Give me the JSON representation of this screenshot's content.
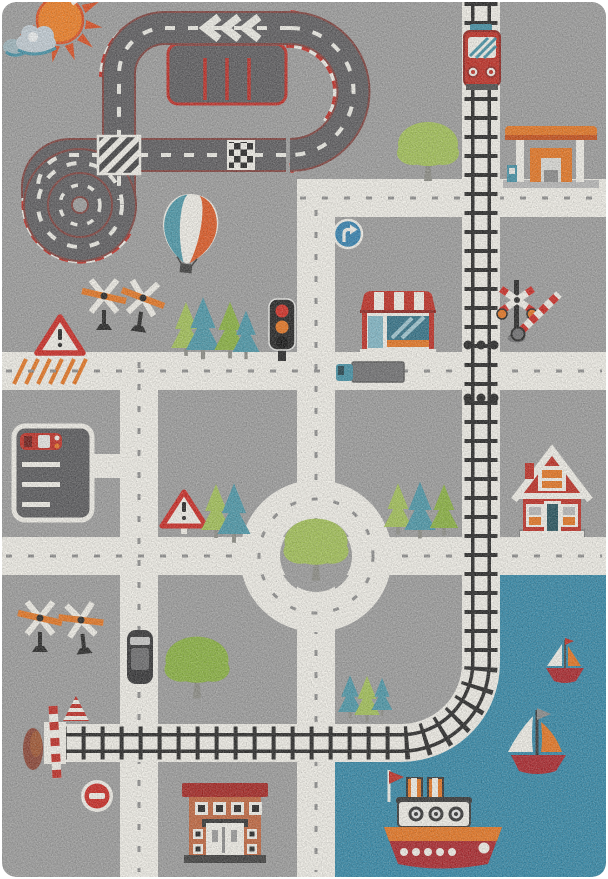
{
  "photo": {
    "subject": "children's city-road play rug, top view product photo",
    "backdrop": "white",
    "style": "knitted / heathered pile texture"
  },
  "palette": {
    "bg": "#9c9c9c",
    "roadWhite": "#f3f1ea",
    "roadTick": "#8d8d8d",
    "asphalt": "#5a595c",
    "asphaltEdge": "#7e3c38",
    "trackDash": "#f0efe8",
    "curbRed": "#c1271f",
    "tie": "#222222",
    "water": "#2f86a7",
    "sun": "#f27c1e",
    "sunRay": "#dd4a1c",
    "cloud": "#c3ced6",
    "cloudDark": "#9fb7bf",
    "teal": "#3e8fa5",
    "tealDark": "#2d6f86",
    "treeGreen": "#a2c254",
    "treeGreen2": "#88b23c",
    "pineTeal": "#4796a8",
    "trunk": "#8b8b84",
    "red": "#c0281e",
    "darkRed": "#8e1d18",
    "orange": "#e8731c",
    "signRed": "#cc231d",
    "signBlue": "#2d7fb0",
    "ink": "#1f1f1f",
    "mid": "#6e6e70",
    "terracotta": "#c2633a",
    "roofRed": "#a51f1c",
    "boatRed": "#aa2026",
    "steel": "#b9b9b9"
  },
  "scene": {
    "sky": [
      "sun",
      "clouds"
    ],
    "race_track": [
      "loop-the-loop spiral",
      "hairpin bend",
      "chevron-arrows",
      "pit-parking boxes",
      "checkered-finish-line",
      "striped-crossing",
      "red-white-curbs"
    ],
    "railway": [
      "red-train",
      "vertical-line",
      "curve-to-harbor",
      "buffer-stop with barrier",
      "crossbuck-signal with gate"
    ],
    "roads": [
      "grid of white roads",
      "roundabout with tree island",
      "orange-hatched marking"
    ],
    "signs": [
      "turn-right-blue-sign",
      "warning-triangle x2",
      "no-entry-sign",
      "traffic-light",
      "windmill-crossing-signals x4"
    ],
    "buildings": [
      "striped-awning shop",
      "red house",
      "gas station",
      "brick building",
      "parking lot with red car"
    ],
    "vehicles": [
      "gray truck with blue cab",
      "black car",
      "red parked car"
    ],
    "nature": [
      "round trees x3",
      "pine trees",
      "hot-air-balloon"
    ],
    "harbor": [
      "blue water",
      "small sailboat",
      "large sailboat",
      "steamboat with funnels"
    ]
  }
}
